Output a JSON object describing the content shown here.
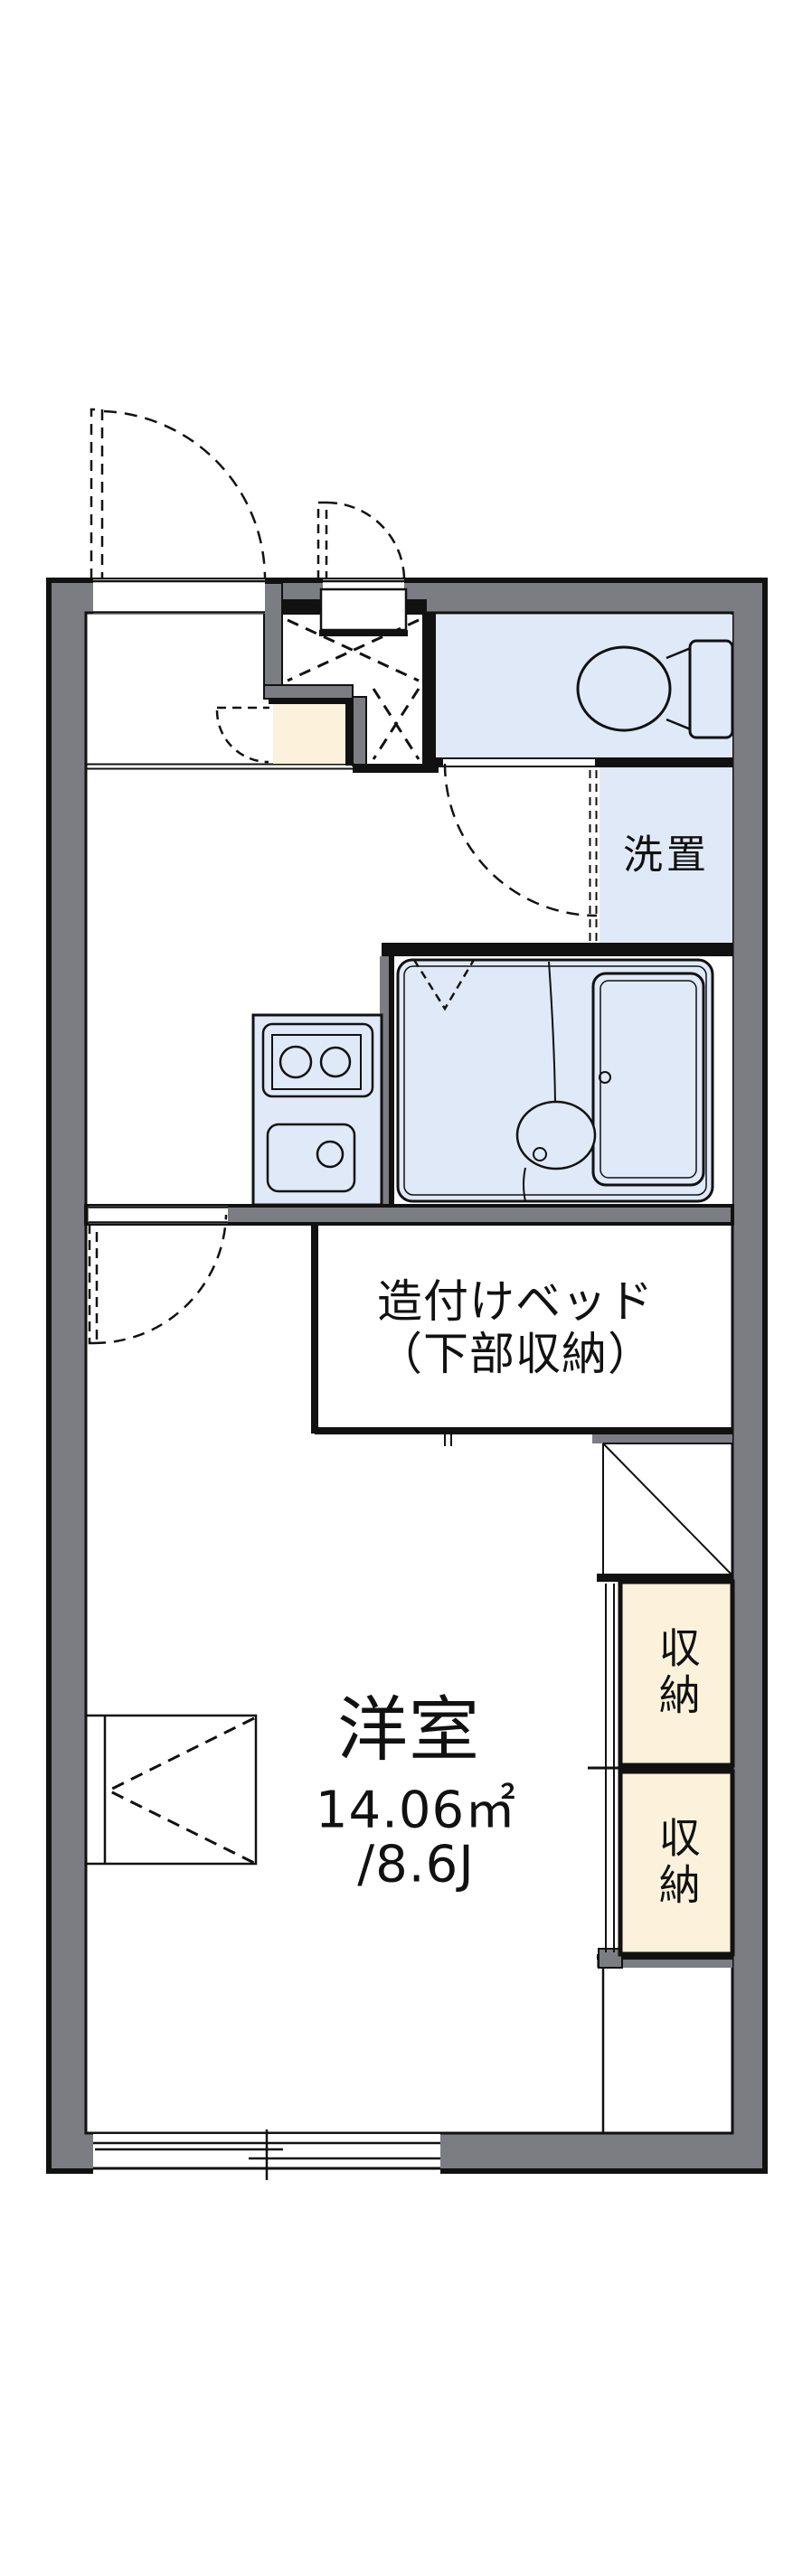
{
  "plan": {
    "type": "apartment-floorplan",
    "labels": {
      "laundry": "洗置",
      "bed_line1": "造付けベッド",
      "bed_line2": "（下部収納）",
      "room": "洋室",
      "area_sqm": "14.06㎡",
      "area_tatami": "/8.6J",
      "storage_top": "収納",
      "storage_bottom": "収納"
    },
    "colors": {
      "wall_gray": "#7c7c83",
      "room_blue": "#dfe9f8",
      "storage_cream": "#fcf2dc",
      "line_black": "#111111",
      "background": "#ffffff"
    }
  }
}
